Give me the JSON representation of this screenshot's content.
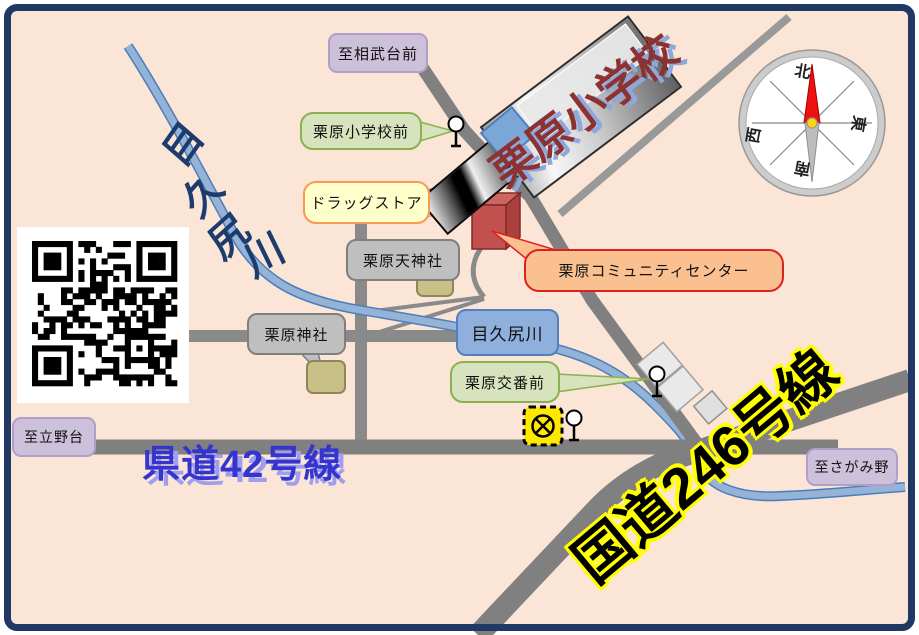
{
  "labels": {
    "to_sobudaimae": "至相武台前",
    "school_bus_stop": "栗原小学校前",
    "drugstore": "ドラッグストア",
    "tenjin_shrine": "栗原天神社",
    "community_center": "栗原コミュニティセンター",
    "kurihara_shrine": "栗原神社",
    "river_box": "目久尻川",
    "koban_bus_stop": "栗原交番前",
    "to_tatenodai": "至立野台",
    "to_sagamino": "至さがみ野"
  },
  "roads": {
    "route42": "県道42号線",
    "route246": "国道246号線"
  },
  "river": {
    "name": "目久尻川"
  },
  "school": {
    "name": "栗原小学校"
  },
  "compass": {
    "north": "北",
    "south": "南",
    "east": "東",
    "west": "西"
  },
  "colors": {
    "background": "#fbe5d6",
    "frame": "#1f3864",
    "road_gray": "#808080",
    "river_fill": "#94b3d7",
    "river_edge": "#4a7ebb",
    "route42_text": "#3434cf",
    "route246_fill": "#000000",
    "route246_outline": "#ffff00",
    "school_text": "#8c3331",
    "community_building": "#c1504e",
    "police_icon": "#ffe800",
    "bubble_purple": "#ccc0da",
    "bubble_green": "#d6e3bc",
    "bubble_gray": "#bfbfbf",
    "bubble_yellow": "#ffffcc",
    "bubble_orange": "#fac08f",
    "river_label_color": "#1c3c6e"
  }
}
